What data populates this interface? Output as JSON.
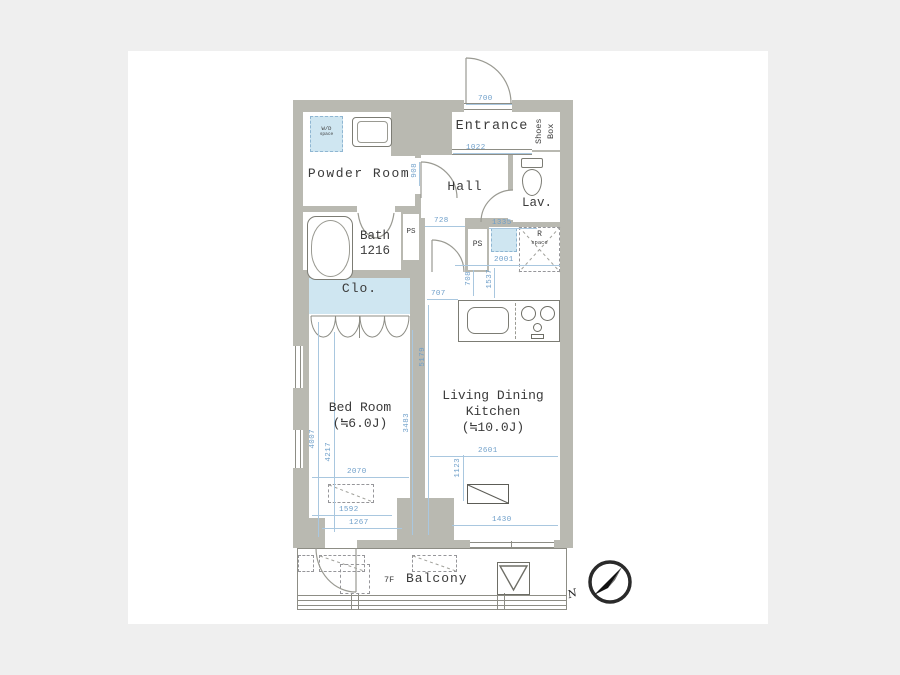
{
  "colors": {
    "background": "#efefef",
    "sheet": "#ffffff",
    "wall_gray": "#b9b9b1",
    "closet_blue": "#cfe6f1",
    "dimension_blue": "#6d9ec9",
    "label_dark": "#3b3b3b"
  },
  "rooms": {
    "entrance": {
      "label": "Entrance"
    },
    "shoes_box": {
      "line1": "Shoes",
      "line2": "Box"
    },
    "powder_room": {
      "label": "Powder Room"
    },
    "wd_space": {
      "line1": "W/D",
      "line2": "space"
    },
    "hall": {
      "label": "Hall"
    },
    "lavatory": {
      "label": "Lav."
    },
    "bath": {
      "line1": "Bath",
      "line2": "1216"
    },
    "ps_left": {
      "label": "PS"
    },
    "ps_right": {
      "label": "PS"
    },
    "r_space": {
      "line1": "R",
      "line2": "space"
    },
    "closet": {
      "label": "Clo."
    },
    "bedroom": {
      "name": "Bed Room",
      "size": "(≒6.0J)"
    },
    "ldk": {
      "line1": "Living Dining",
      "line2": "Kitchen",
      "line3": "(≒10.0J)"
    },
    "balcony": {
      "label": "Balcony",
      "floor": "7F"
    }
  },
  "compass": {
    "label": "N"
  },
  "dimensions": [
    {
      "v": "700",
      "o": "h",
      "tx": 478,
      "ty": 96,
      "lx": 466,
      "ly": 104,
      "ll": 46
    },
    {
      "v": "1022",
      "o": "h",
      "tx": 466,
      "ty": 145,
      "lx": 453,
      "ly": 153,
      "ll": 79
    },
    {
      "v": "908",
      "o": "v",
      "tx": 412,
      "ty": 163,
      "lx": 419,
      "ly": 162,
      "ll": 24
    },
    {
      "v": "728",
      "o": "h",
      "tx": 434,
      "ty": 218,
      "lx": 425,
      "ly": 226,
      "ll": 40
    },
    {
      "v": "1335",
      "o": "h",
      "tx": 492,
      "ty": 220,
      "lx": 489,
      "ly": 228,
      "ll": 48
    },
    {
      "v": "2001",
      "o": "h",
      "tx": 494,
      "ty": 257,
      "lx": 455,
      "ly": 265,
      "ll": 105
    },
    {
      "v": "708",
      "o": "v",
      "tx": 466,
      "ty": 271,
      "lx": 473,
      "ly": 270,
      "ll": 26
    },
    {
      "v": "1537",
      "o": "v",
      "tx": 487,
      "ty": 269,
      "lx": 494,
      "ly": 268,
      "ll": 30
    },
    {
      "v": "707",
      "o": "h",
      "tx": 431,
      "ty": 291,
      "lx": 427,
      "ly": 299,
      "ll": 31
    },
    {
      "v": "5179",
      "o": "v",
      "tx": 420,
      "ty": 347,
      "lx": 428,
      "ly": 305,
      "ll": 230
    },
    {
      "v": "3483",
      "o": "v",
      "tx": 404,
      "ty": 413,
      "lx": 412,
      "ly": 330,
      "ll": 205
    },
    {
      "v": "4007",
      "o": "v",
      "tx": 310,
      "ty": 429,
      "lx": 318,
      "ly": 322,
      "ll": 215
    },
    {
      "v": "4217",
      "o": "v",
      "tx": 326,
      "ty": 442,
      "lx": 334,
      "ly": 332,
      "ll": 200
    },
    {
      "v": "2070",
      "o": "h",
      "tx": 347,
      "ty": 469,
      "lx": 312,
      "ly": 477,
      "ll": 97
    },
    {
      "v": "2601",
      "o": "h",
      "tx": 478,
      "ty": 448,
      "lx": 430,
      "ly": 456,
      "ll": 128
    },
    {
      "v": "1123",
      "o": "v",
      "tx": 455,
      "ty": 458,
      "lx": 463,
      "ly": 455,
      "ll": 46
    },
    {
      "v": "1592",
      "o": "h",
      "tx": 339,
      "ty": 507,
      "lx": 312,
      "ly": 515,
      "ll": 80
    },
    {
      "v": "1267",
      "o": "h",
      "tx": 349,
      "ty": 520,
      "lx": 322,
      "ly": 528,
      "ll": 80
    },
    {
      "v": "1430",
      "o": "h",
      "tx": 492,
      "ty": 517,
      "lx": 452,
      "ly": 525,
      "ll": 106
    }
  ]
}
